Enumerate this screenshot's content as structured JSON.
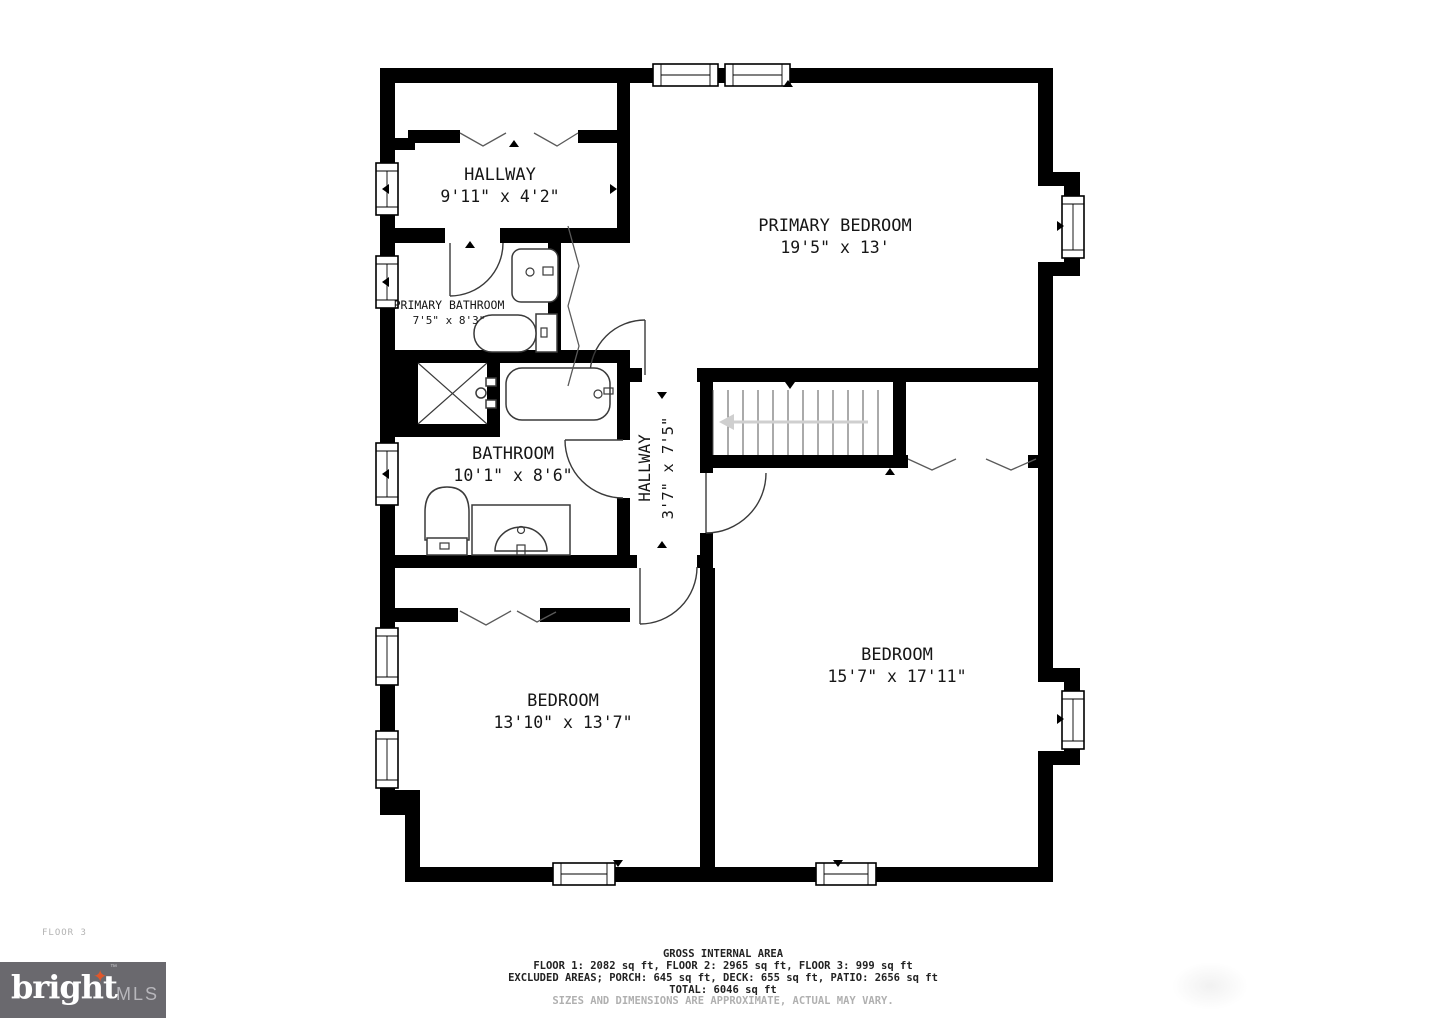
{
  "floor_label": "FLOOR 3",
  "rooms": {
    "hallway_top": {
      "name": "HALLWAY",
      "dims": "9'11\" x 4'2\""
    },
    "primary_bedroom": {
      "name": "PRIMARY BEDROOM",
      "dims": "19'5\" x 13'"
    },
    "primary_bathroom": {
      "name": "PRIMARY BATHROOM",
      "dims": "7'5\" x 8'3\""
    },
    "bathroom": {
      "name": "BATHROOM",
      "dims": "10'1\" x 8'6\""
    },
    "hallway_center": {
      "name": "HALLWAY",
      "dims": "3'7\" x 7'5\""
    },
    "bedroom_right": {
      "name": "BEDROOM",
      "dims": "15'7\" x 17'11\""
    },
    "bedroom_left": {
      "name": "BEDROOM",
      "dims": "13'10\" x 13'7\""
    }
  },
  "footer": {
    "title": "GROSS INTERNAL AREA",
    "line1": "FLOOR 1: 2082 sq ft, FLOOR 2: 2965 sq ft, FLOOR 3: 999 sq ft",
    "line2": "EXCLUDED AREAS; PORCH: 645 sq ft, DECK: 655 sq ft, PATIO: 2656 sq ft",
    "line3": "TOTAL: 6046 sq ft",
    "disclaimer": "SIZES AND DIMENSIONS ARE APPROXIMATE, ACTUAL MAY VARY."
  },
  "logo": {
    "brand": "bright",
    "suffix": "MLS",
    "tm": "TM",
    "star": "✦",
    "bg_color": "#6a696e",
    "star_color": "#e0572b"
  },
  "colors": {
    "wall": "#000000",
    "line": "#3a3a3a",
    "stair_arrow": "#cfcfcf",
    "text": "#161616",
    "muted_text": "#b0b0b0"
  }
}
